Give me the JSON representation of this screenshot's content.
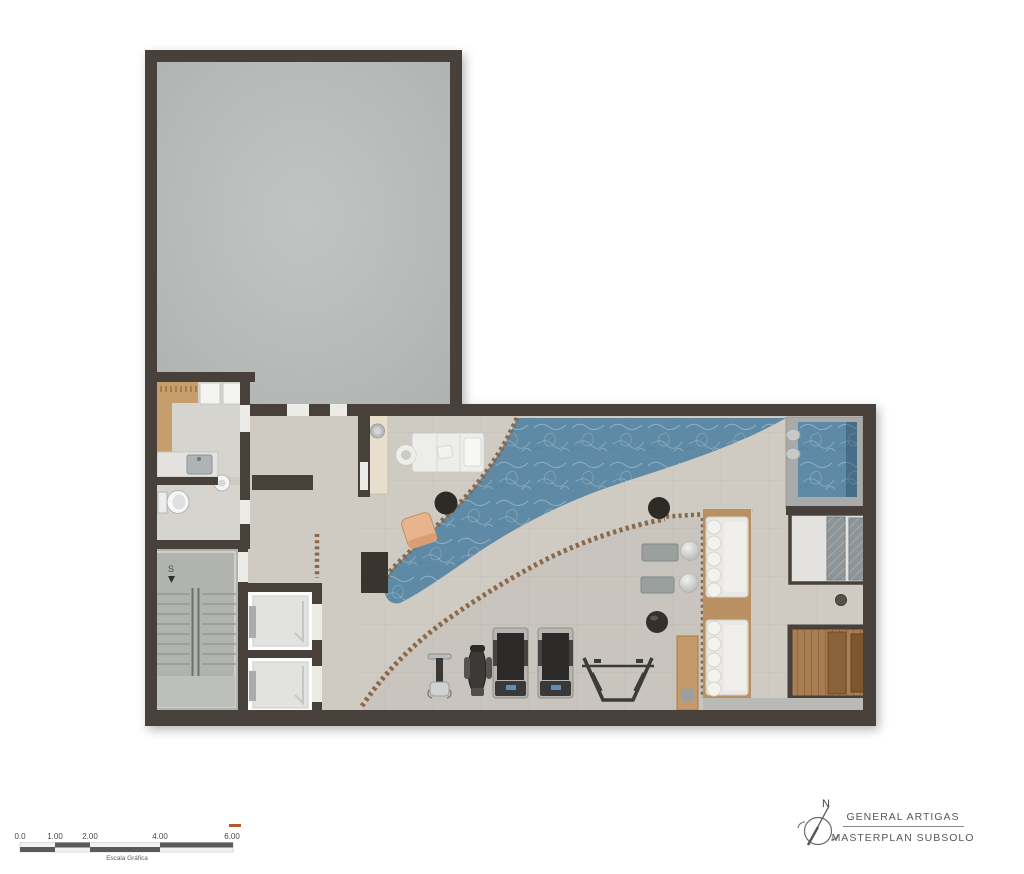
{
  "title_block": {
    "project": "GENERAL ARTIGAS",
    "sheet": "MASTERPLAN SUBSOLO",
    "north_label": "N"
  },
  "scale_bar": {
    "labels": [
      "0.0",
      "1.00",
      "2.00",
      "4.00",
      "6.00"
    ],
    "caption": "Escala Gráfica"
  },
  "plan": {
    "stair_label": "S",
    "rooms": [
      "unexcavated-area",
      "changing-room",
      "wc",
      "stairwell",
      "elevators",
      "corridor",
      "spa-massage-area",
      "pool",
      "plunge-pool",
      "gym",
      "lounge-platform",
      "shower-room",
      "sauna"
    ],
    "fixtures": [
      "massage-table",
      "ring-stool",
      "vessel-basin-counter",
      "lounge-chair",
      "round-side-table",
      "wall-planter",
      "wood-bench-with-hooks",
      "shower-stalls",
      "vanity-sink",
      "toilet",
      "corner-basin",
      "weight-bench",
      "elliptical-trainer",
      "treadmill",
      "treadmill",
      "squat-rack",
      "wood-desk",
      "stool",
      "sofa",
      "sofa",
      "gym-bench",
      "gym-bench",
      "exercise-ball",
      "exercise-ball",
      "massage-slabs",
      "sauna-benches",
      "deck-steps"
    ]
  },
  "colors": {
    "wall": "#48413b",
    "floor": "#cfcbc3",
    "grayroom": "#babdbb",
    "stair": "#b1b3af",
    "water": "#5f8aa5",
    "deck": "#8a684a",
    "woodLight": "#c59e6b",
    "sauna": "#a87e52",
    "beige": "#e7dfcc",
    "peach": "#e8b48d",
    "dark": "#322e2a",
    "grayitem": "#9aa09e",
    "slate": "#8e9599",
    "stone": "#a8aba9"
  }
}
